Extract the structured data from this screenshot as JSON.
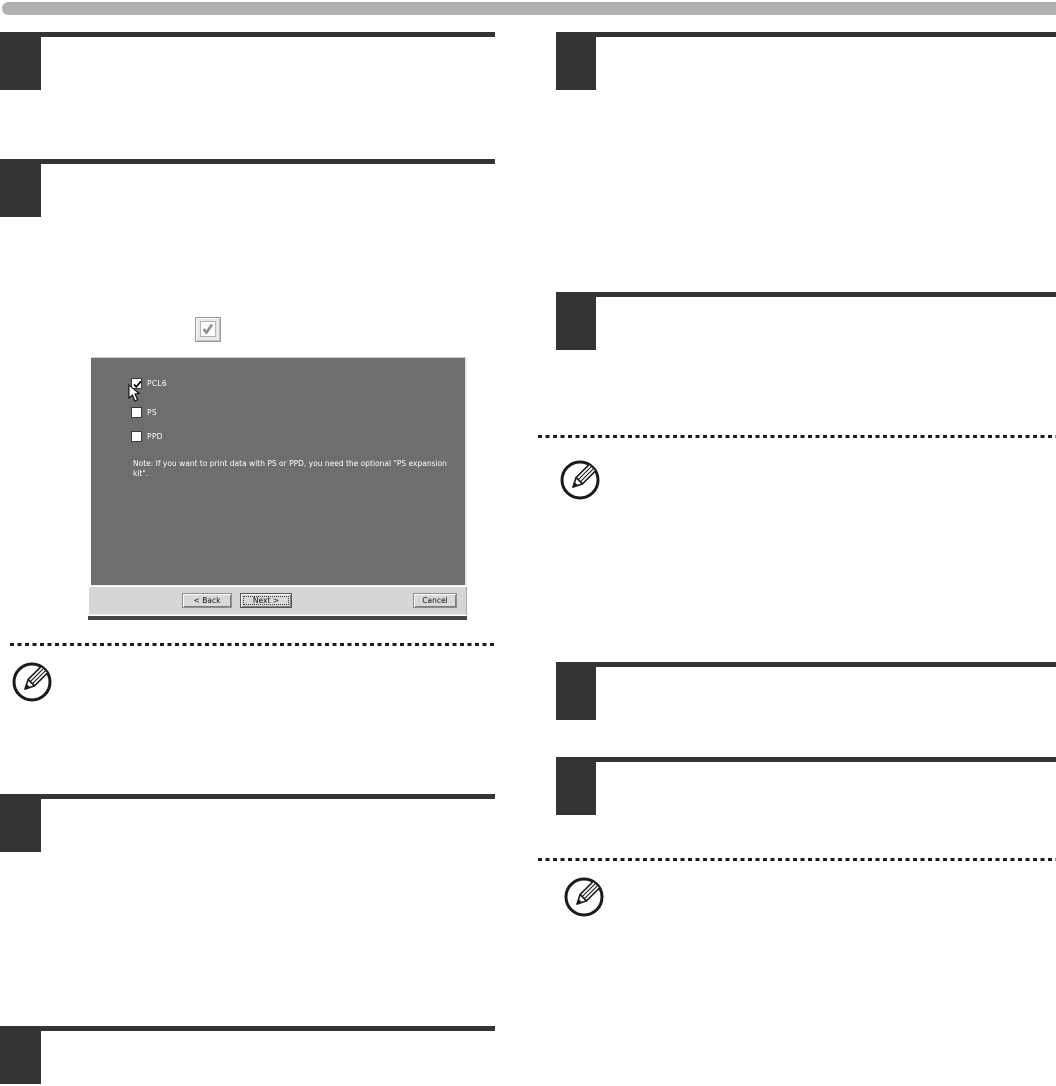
{
  "page": {
    "background": "#ffffff",
    "top_bar_color": "#b1b1b1",
    "step_block_color": "#343434",
    "dotted_line_color": "#1c1c1c"
  },
  "checkbox_graphic": {
    "state": "checked",
    "frame_color": "#9a9a9a",
    "check_color": "#8f8f8f"
  },
  "installer_dialog": {
    "background_color": "#6e6e6e",
    "button_bar_color": "#d6d6d6",
    "checkboxes": [
      {
        "label": "PCL6",
        "checked": true
      },
      {
        "label": "PS",
        "checked": false
      },
      {
        "label": "PPD",
        "checked": false
      }
    ],
    "note": "Note: If you want to print data with PS or PPD, you need the optional \"PS expansion kit\".",
    "buttons": {
      "back": "< Back",
      "next": "Next >",
      "cancel": "Cancel"
    }
  }
}
